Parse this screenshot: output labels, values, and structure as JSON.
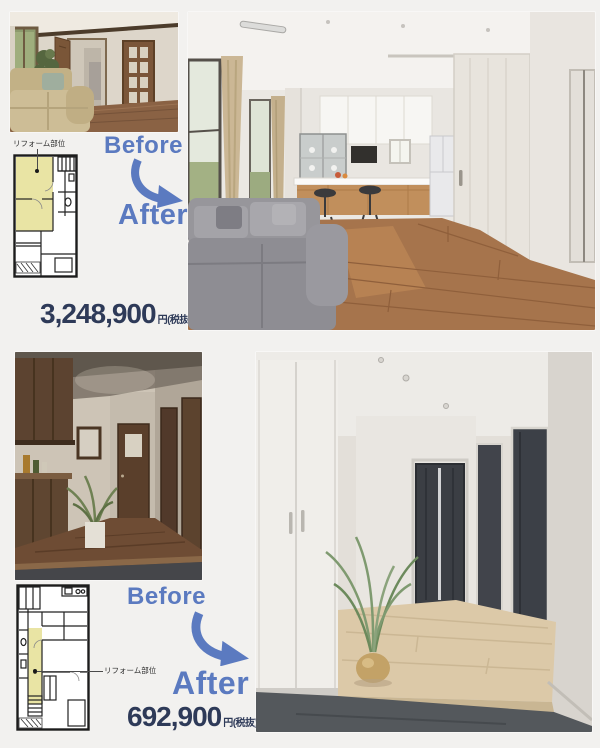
{
  "page": {
    "background": "#f2f1ef"
  },
  "colors": {
    "accent_blue": "#5b7ac0",
    "price_navy": "#2e3a58",
    "plan_highlight": "#e9e4a4"
  },
  "sections": [
    {
      "name": "living-dining-kitchen",
      "before_label": "Before",
      "after_label": "After",
      "price_value": "3,248,900",
      "price_unit": "円(税抜)",
      "plan_note": "リフォーム部位"
    },
    {
      "name": "entrance-hallway",
      "before_label": "Before",
      "after_label": "After",
      "price_value": "692,900",
      "price_unit": "円(税抜)",
      "plan_note": "リフォーム部位"
    }
  ]
}
